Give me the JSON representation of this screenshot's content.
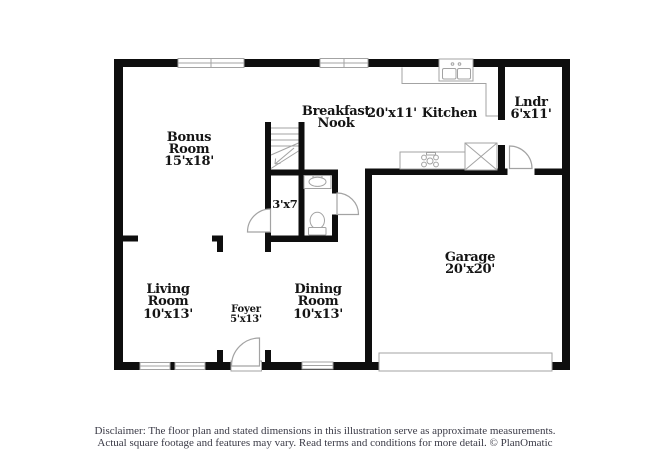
{
  "plan": {
    "rooms": [
      {
        "id": "bonus-room",
        "name": "Bonus Room",
        "dims": "15'x18'"
      },
      {
        "id": "breakfast-nook",
        "name": "Breakfast Nook",
        "dims": ""
      },
      {
        "id": "kitchen",
        "name": "Kitchen",
        "dims": "20'x11'"
      },
      {
        "id": "laundry",
        "name": "Lndr",
        "dims": "6'x11'"
      },
      {
        "id": "garage",
        "name": "Garage",
        "dims": "20'x20'"
      },
      {
        "id": "living-room",
        "name": "Living Room",
        "dims": "10'x13'"
      },
      {
        "id": "foyer",
        "name": "Foyer",
        "dims": "5'x13'"
      },
      {
        "id": "dining-room",
        "name": "Dining Room",
        "dims": "10'x13'"
      },
      {
        "id": "hall-closet",
        "name": "",
        "dims": "3'x7'"
      }
    ]
  },
  "footer": {
    "disclaimer_line1": "Disclaimer: The floor plan and stated dimensions in this illustration serve as approximate measurements.",
    "disclaimer_line2": "Actual square footage and features may vary. Read terms and conditions for more detail. © PlanOmatic"
  },
  "colors": {
    "wall": "#0e0e0e",
    "fixture_line": "#a3a3a3",
    "label_text": "#141414",
    "disclaimer_text": "#3a3a46",
    "background": "#ffffff"
  }
}
